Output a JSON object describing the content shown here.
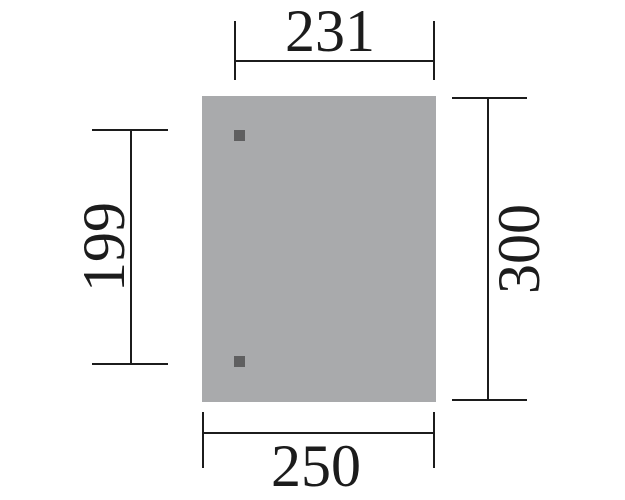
{
  "colors": {
    "background": "#ffffff",
    "line": "#1c1c1c",
    "text": "#1c1c1c",
    "panel_fill": "#a9aaac",
    "post_fill": "#5f5f60"
  },
  "dimensions": {
    "top": {
      "label": "231"
    },
    "left": {
      "label": "199"
    },
    "right": {
      "label": "300"
    },
    "bottom": {
      "label": "250"
    }
  },
  "posts": {
    "count": 2
  }
}
